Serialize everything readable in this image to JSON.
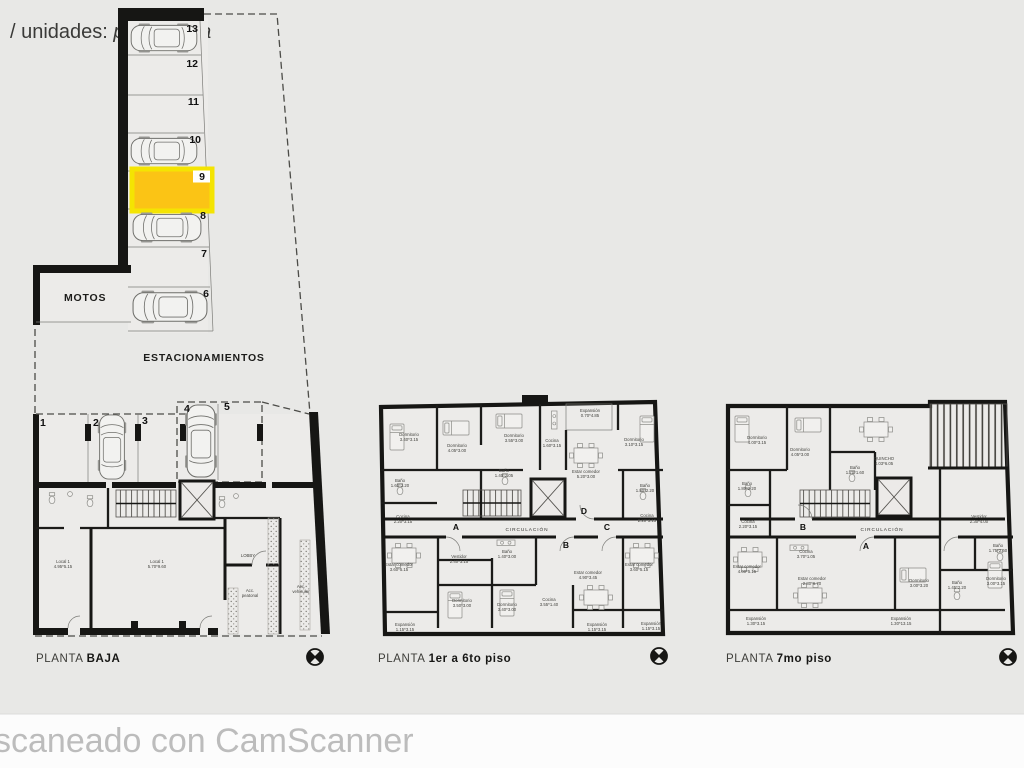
{
  "header": {
    "prefix": "/ unidades: ",
    "italic": "planimetria"
  },
  "watermark": "scaneado con CamScanner",
  "parking": {
    "motos_label": "MOTOS",
    "estacionamientos_label": "ESTACIONAMIENTOS",
    "highlight_color": "#fbc415",
    "highlight_border": "#f4e402",
    "column_spaces": [
      {
        "num": "13",
        "car": true
      },
      {
        "num": "12",
        "car": false
      },
      {
        "num": "11",
        "car": false
      },
      {
        "num": "10",
        "car": true
      },
      {
        "num": "9",
        "car": false,
        "highlighted": true
      },
      {
        "num": "8",
        "car": true
      },
      {
        "num": "7",
        "car": false
      },
      {
        "num": "6",
        "car": true
      }
    ],
    "ground_spaces": [
      {
        "num": "1",
        "car": false
      },
      {
        "num": "2",
        "car": true
      },
      {
        "num": "3",
        "car": false
      },
      {
        "num": "4",
        "car": true
      },
      {
        "num": "5",
        "car": false
      }
    ]
  },
  "plans": {
    "baja": {
      "title_prefix": "PLANTA ",
      "title_bold": "BAJA",
      "rooms": [
        {
          "name": "Local 1",
          "dims": "4.95*5.15"
        },
        {
          "name": "Local 1",
          "dims": "5.70*9.60"
        },
        {
          "name": "LOBBY",
          "dims": ""
        },
        {
          "name": "Acc.",
          "dims": "peatonal"
        },
        {
          "name": "Acc.",
          "dims": "vehicular"
        }
      ]
    },
    "piso1a6": {
      "title_prefix": "PLANTA ",
      "title_bold": "1er a 6to piso",
      "circulacion": "CIRCULACIÓN",
      "letters": [
        "A",
        "B",
        "C",
        "D"
      ],
      "rooms": [
        {
          "name": "Dormitorio",
          "dims": "3.40*3.15"
        },
        {
          "name": "Dormitorio",
          "dims": "4.05*3.00"
        },
        {
          "name": "Dormitorio",
          "dims": "3.55*3.00"
        },
        {
          "name": "Cocina",
          "dims": "1.60*3.15"
        },
        {
          "name": "Expansión",
          "dims": "0.70*4.85"
        },
        {
          "name": "Dormitorio",
          "dims": "3.10*3.15"
        },
        {
          "name": "Estar comedor",
          "dims": "5.20*3.00"
        },
        {
          "name": "Baño",
          "dims": "1.60*2.20"
        },
        {
          "name": "Baño",
          "dims": "1.40*2.05"
        },
        {
          "name": "Baño",
          "dims": "1.80*2.20"
        },
        {
          "name": "Cocina",
          "dims": "2.20*3.15"
        },
        {
          "name": "Cocina",
          "dims": "2.20*3.15"
        },
        {
          "name": "Vestidor",
          "dims": "2.40*3.15"
        },
        {
          "name": "Baño",
          "dims": "1.40*3.00"
        },
        {
          "name": "Estar comedor",
          "dims": "3.60*5.15"
        },
        {
          "name": "Estar comedor",
          "dims": "4.90*3.45"
        },
        {
          "name": "Dormitorio",
          "dims": "3.50*3.00"
        },
        {
          "name": "Dormitorio",
          "dims": "3.40*3.00"
        },
        {
          "name": "Cocina",
          "dims": "3.55*1.40"
        },
        {
          "name": "Estar comedor",
          "dims": "3.60*5.15"
        },
        {
          "name": "Expansión",
          "dims": "1.15*3.15"
        },
        {
          "name": "Expansión",
          "dims": "1.15*3.15"
        },
        {
          "name": "Expansión",
          "dims": "1.15*3.15"
        }
      ]
    },
    "piso7": {
      "title_prefix": "PLANTA ",
      "title_bold": "7mo piso",
      "circulacion": "CIRCULACIÓN",
      "letters": [
        "A",
        "B"
      ],
      "rooms": [
        {
          "name": "Dormitorio",
          "dims": "4.00*3.15"
        },
        {
          "name": "Dormitorio",
          "dims": "4.05*3.00"
        },
        {
          "name": "QUINCHO",
          "dims": "4.03*6.05"
        },
        {
          "name": "Baño",
          "dims": "1.70*1.60"
        },
        {
          "name": "Baño",
          "dims": "1.80*2.20"
        },
        {
          "name": "Cocina",
          "dims": "2.20*3.15"
        },
        {
          "name": "Vestidor",
          "dims": "2.30*4.00"
        },
        {
          "name": "Cocina",
          "dims": "3.70*1.05"
        },
        {
          "name": "Estar comedor",
          "dims": "2.80*6.70"
        },
        {
          "name": "Estar comedor",
          "dims": "4.00*5.15"
        },
        {
          "name": "Dormitorio",
          "dims": "3.00*3.20"
        },
        {
          "name": "Baño",
          "dims": "1.45*2.20"
        },
        {
          "name": "Dormitorio",
          "dims": "3.00*3.15"
        },
        {
          "name": "Baño",
          "dims": "1.75*2.60"
        },
        {
          "name": "Expansión",
          "dims": "1.30*3.15"
        },
        {
          "name": "Expansión",
          "dims": "1.30*13.15"
        }
      ]
    }
  }
}
